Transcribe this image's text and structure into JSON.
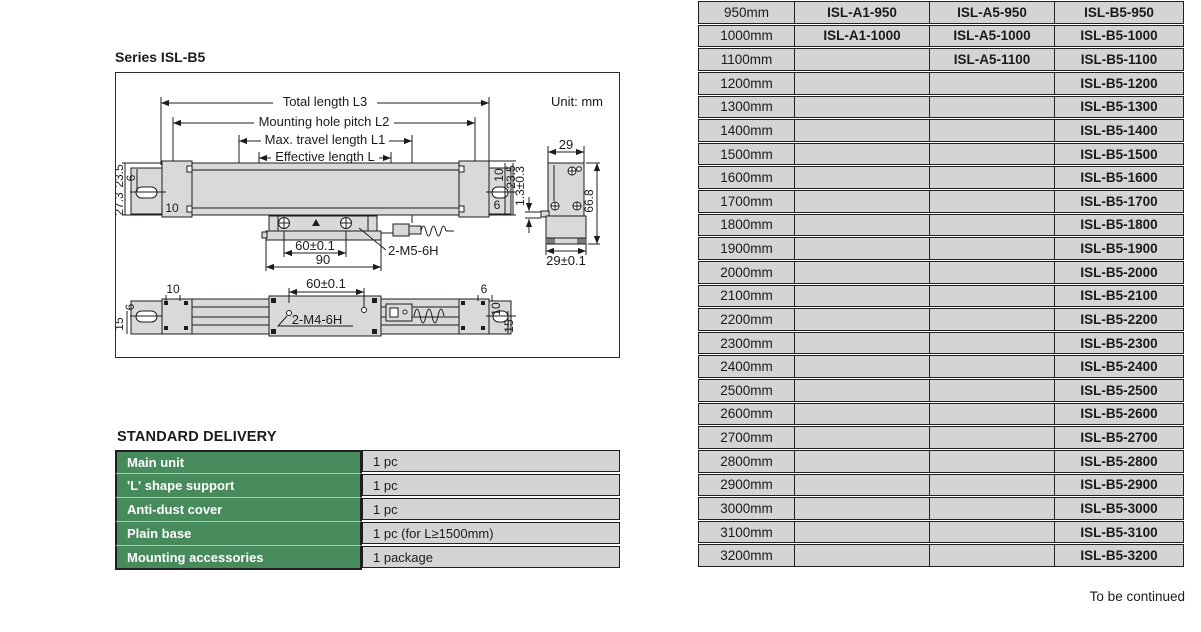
{
  "page": {
    "series_title": "Series ISL-B5",
    "to_be_continued": "To be continued"
  },
  "colors": {
    "green": "#478a5c",
    "green_separator": "#a9c9b1",
    "cell_gray": "#d3d4d6",
    "line_dark": "#1f1f1f"
  },
  "diagram": {
    "unit": "Unit: mm",
    "dims": {
      "l3": "Total length L3",
      "l2": "Mounting hole pitch L2",
      "l1": "Max. travel length L1",
      "l": "Effective length L",
      "fl_23_5": "23.5",
      "fl_6": "6",
      "fl_27_3": "27.3",
      "fl_10": "10",
      "fr_10": "10",
      "fr_23_5": "23.5",
      "fr_6": "6",
      "s_60": "60±0.1",
      "s_90": "90",
      "s_m5": "2-M5-6H",
      "sv_29": "29",
      "sv_66_8": "66.8",
      "sv_13": "1.3±0.3",
      "sv_29_01": "29±0.1",
      "b_60": "60±0.1",
      "b_m4": "2-M4-6H",
      "bl_10": "10",
      "bl_6": "6",
      "bl_15": "15",
      "br_6": "6",
      "br_10": "10",
      "br_15": "15"
    }
  },
  "standard_delivery": {
    "title": "STANDARD DELIVERY",
    "rows": [
      {
        "item": "Main unit",
        "qty": "1 pc"
      },
      {
        "item": "'L' shape support",
        "qty": "1 pc"
      },
      {
        "item": "Anti-dust cover",
        "qty": "1 pc"
      },
      {
        "item": "Plain base",
        "qty": "1 pc (for L≥1500mm)"
      },
      {
        "item": "Mounting accessories",
        "qty": "1 package"
      }
    ]
  },
  "model_table": {
    "rows": [
      {
        "size": "950mm",
        "a1": "ISL-A1-950",
        "a5": "ISL-A5-950",
        "b5": "ISL-B5-950"
      },
      {
        "size": "1000mm",
        "a1": "ISL-A1-1000",
        "a5": "ISL-A5-1000",
        "b5": "ISL-B5-1000"
      },
      {
        "size": "1100mm",
        "a1": "",
        "a5": "ISL-A5-1100",
        "b5": "ISL-B5-1100"
      },
      {
        "size": "1200mm",
        "a1": "",
        "a5": "",
        "b5": "ISL-B5-1200"
      },
      {
        "size": "1300mm",
        "a1": "",
        "a5": "",
        "b5": "ISL-B5-1300"
      },
      {
        "size": "1400mm",
        "a1": "",
        "a5": "",
        "b5": "ISL-B5-1400"
      },
      {
        "size": "1500mm",
        "a1": "",
        "a5": "",
        "b5": "ISL-B5-1500"
      },
      {
        "size": "1600mm",
        "a1": "",
        "a5": "",
        "b5": "ISL-B5-1600"
      },
      {
        "size": "1700mm",
        "a1": "",
        "a5": "",
        "b5": "ISL-B5-1700"
      },
      {
        "size": "1800mm",
        "a1": "",
        "a5": "",
        "b5": "ISL-B5-1800"
      },
      {
        "size": "1900mm",
        "a1": "",
        "a5": "",
        "b5": "ISL-B5-1900"
      },
      {
        "size": "2000mm",
        "a1": "",
        "a5": "",
        "b5": "ISL-B5-2000"
      },
      {
        "size": "2100mm",
        "a1": "",
        "a5": "",
        "b5": "ISL-B5-2100"
      },
      {
        "size": "2200mm",
        "a1": "",
        "a5": "",
        "b5": "ISL-B5-2200"
      },
      {
        "size": "2300mm",
        "a1": "",
        "a5": "",
        "b5": "ISL-B5-2300"
      },
      {
        "size": "2400mm",
        "a1": "",
        "a5": "",
        "b5": "ISL-B5-2400"
      },
      {
        "size": "2500mm",
        "a1": "",
        "a5": "",
        "b5": "ISL-B5-2500"
      },
      {
        "size": "2600mm",
        "a1": "",
        "a5": "",
        "b5": "ISL-B5-2600"
      },
      {
        "size": "2700mm",
        "a1": "",
        "a5": "",
        "b5": "ISL-B5-2700"
      },
      {
        "size": "2800mm",
        "a1": "",
        "a5": "",
        "b5": "ISL-B5-2800"
      },
      {
        "size": "2900mm",
        "a1": "",
        "a5": "",
        "b5": "ISL-B5-2900"
      },
      {
        "size": "3000mm",
        "a1": "",
        "a5": "",
        "b5": "ISL-B5-3000"
      },
      {
        "size": "3100mm",
        "a1": "",
        "a5": "",
        "b5": "ISL-B5-3100"
      },
      {
        "size": "3200mm",
        "a1": "",
        "a5": "",
        "b5": "ISL-B5-3200"
      }
    ]
  }
}
